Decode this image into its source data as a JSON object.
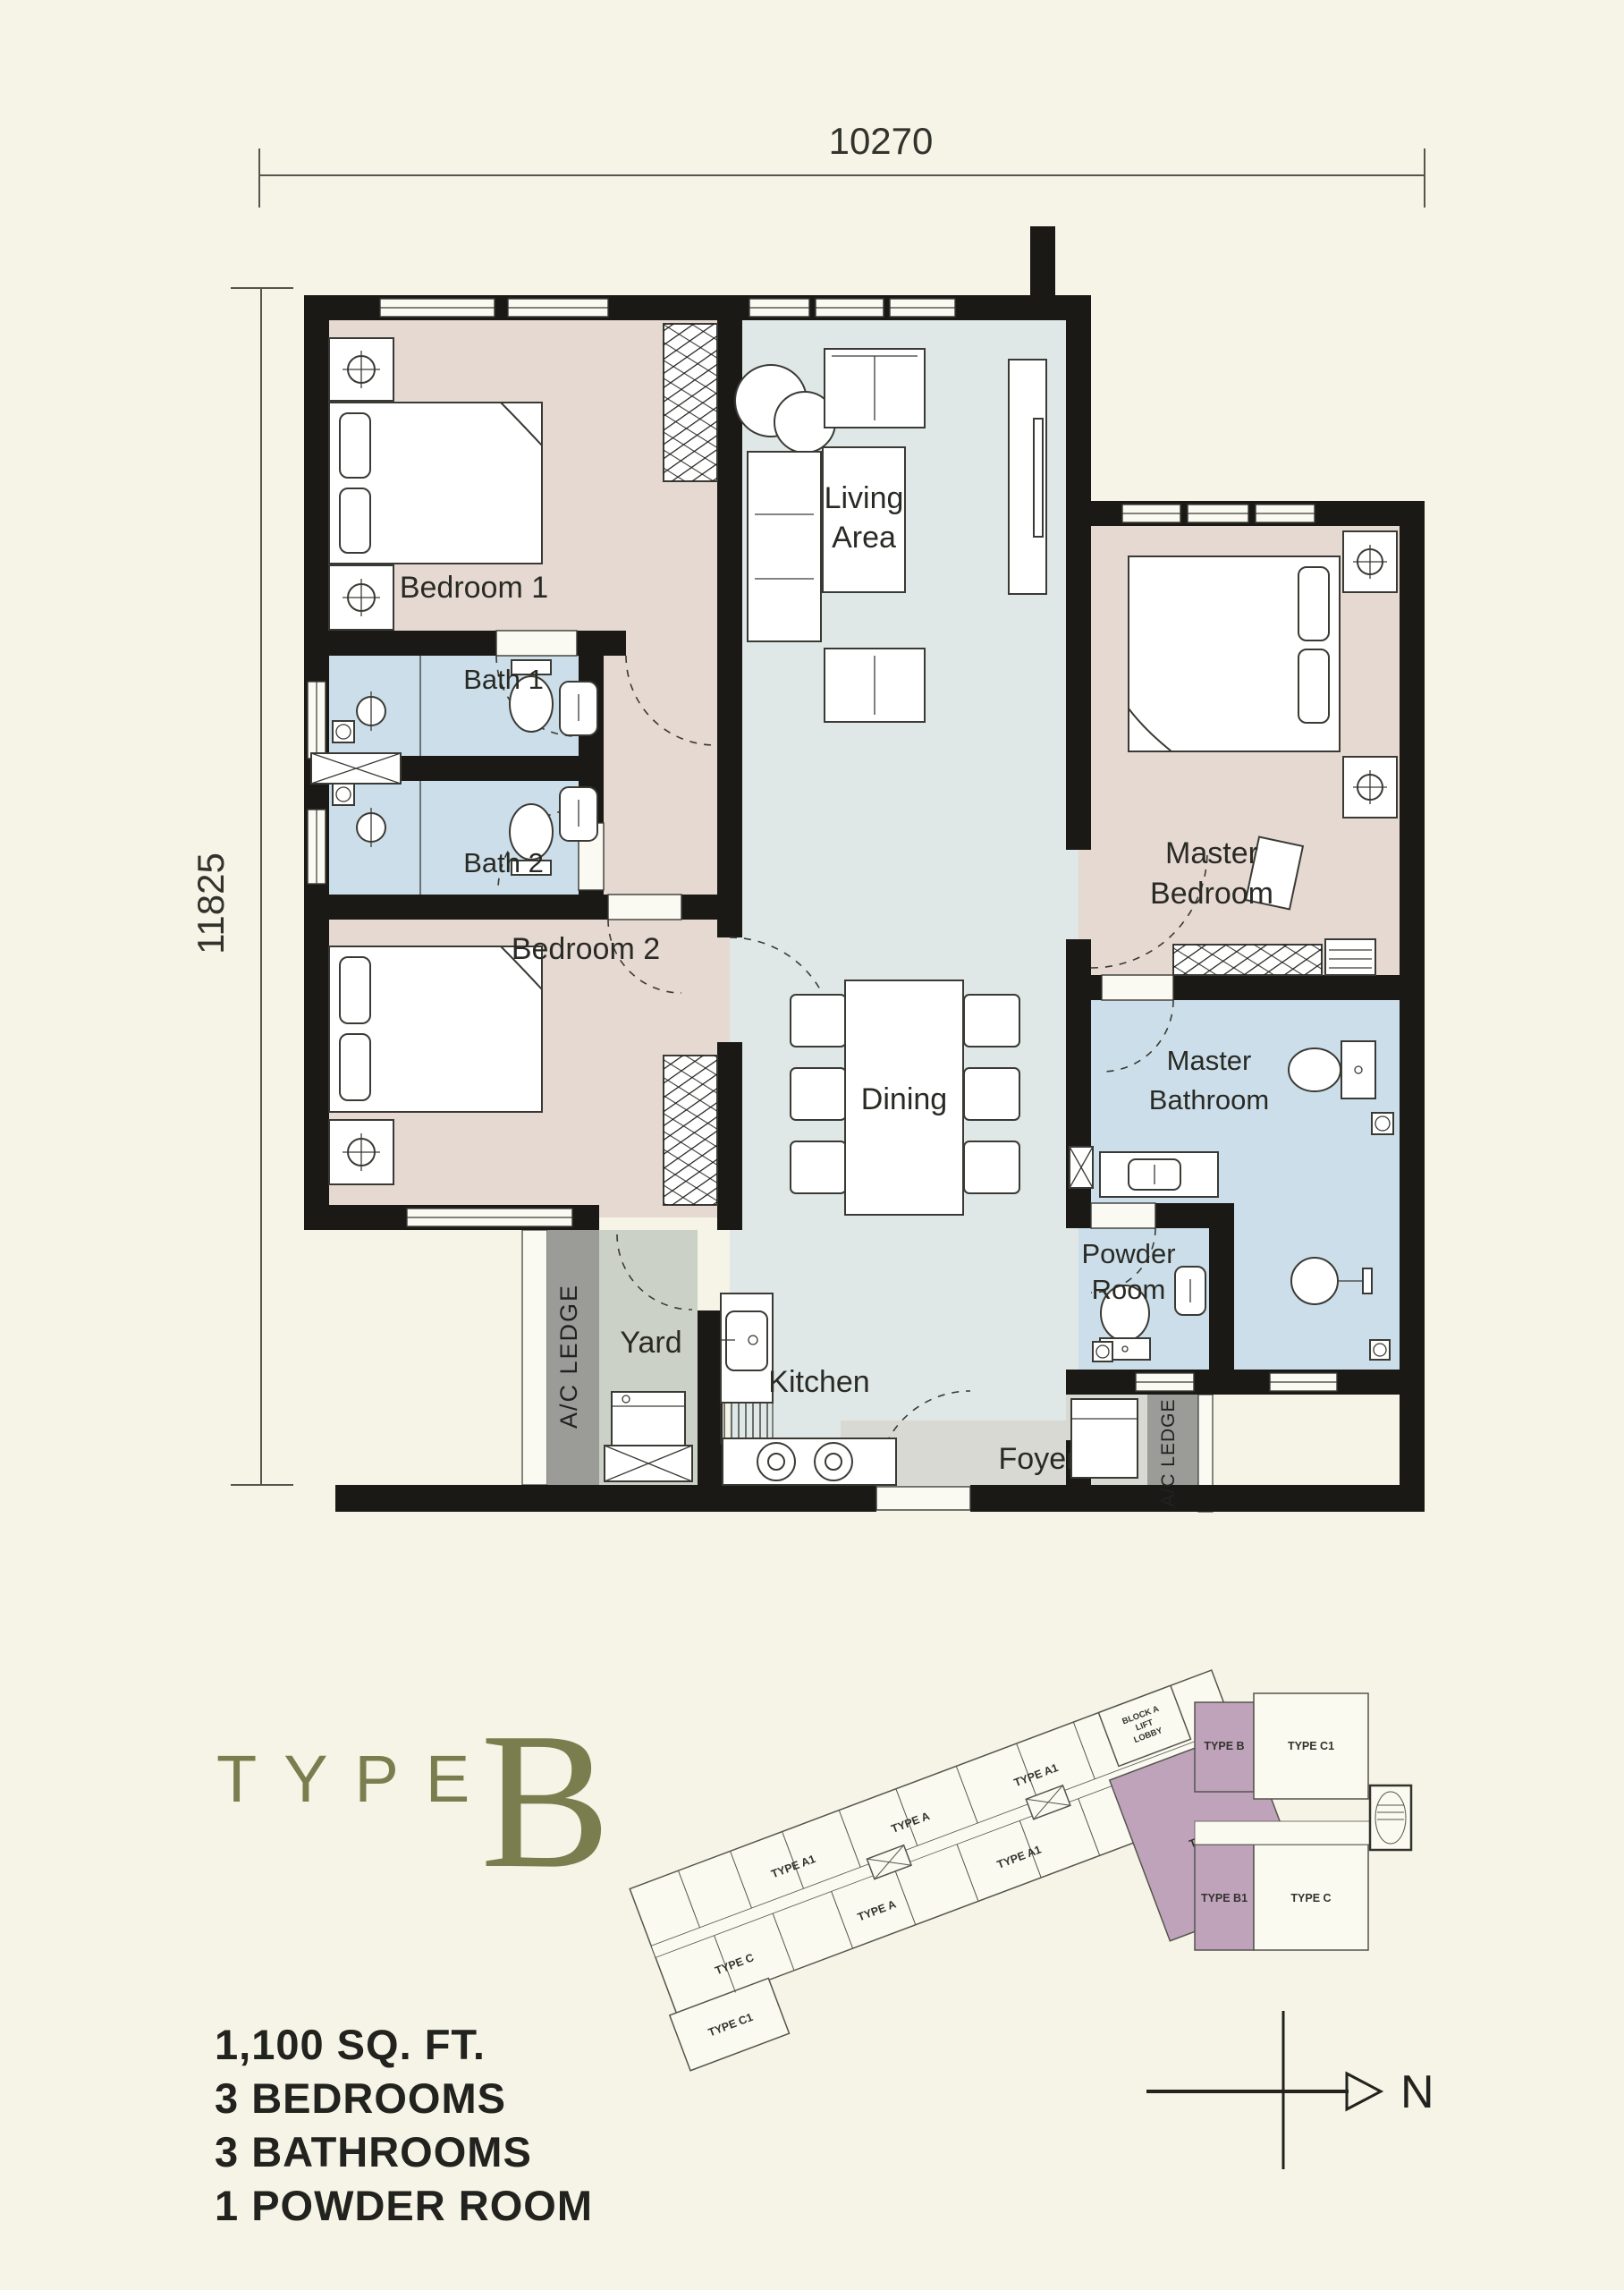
{
  "colors": {
    "background": "#F5F4E6",
    "wall": "#1A1915",
    "bedroom_floor": "#E5D9D1",
    "bath_floor": "#CBDEE9",
    "living_floor": "#DFE8E7",
    "yard_floor": "#CBD1C6",
    "ledge_gray": "#9B9B97",
    "foyer_floor": "#D9D9D3",
    "accent_olive": "#7A7E4E",
    "site_highlight": "#BFA3BB",
    "ink": "#22221E"
  },
  "dimensions": {
    "top": "10270",
    "left": "11825"
  },
  "rooms": {
    "bedroom1": "Bedroom 1",
    "bath1": "Bath 1",
    "bath2": "Bath 2",
    "bedroom2": "Bedroom 2",
    "living_line1": "Living",
    "living_line2": "Area",
    "dining": "Dining",
    "master_bedroom_line1": "Master",
    "master_bedroom_line2": "Bedroom",
    "master_bathroom_line1": "Master",
    "master_bathroom_line2": "Bathroom",
    "powder_line1": "Powder",
    "powder_line2": "Room",
    "yard": "Yard",
    "kitchen": "Kitchen",
    "foyer": "Foyer",
    "ac_ledge_left": "A/C LEDGE",
    "ac_ledge_right": "A/C LEDGE"
  },
  "unit": {
    "type_label": "TYPE",
    "type_letter": "B",
    "stats": [
      "1,100 SQ. FT.",
      "3 BEDROOMS",
      "3 BATHROOMS",
      "1 POWDER ROOM"
    ]
  },
  "site_plan": {
    "north": "N",
    "left_wing": {
      "top_row": [
        "TYPE A1",
        "TYPE A",
        "TYPE A1"
      ],
      "bottom_row": [
        "TYPE C",
        "TYPE A",
        "TYPE A1"
      ],
      "end_unit": "TYPE C1",
      "highlight_unit": "TYPE B",
      "lobby_lines": [
        "BLOCK A",
        "LIFT",
        "LOBBY"
      ]
    },
    "right_block": {
      "unit_top_left": "TYPE B",
      "unit_top_right": "TYPE C1",
      "unit_bottom_left": "TYPE B1",
      "unit_bottom_right": "TYPE C"
    }
  }
}
